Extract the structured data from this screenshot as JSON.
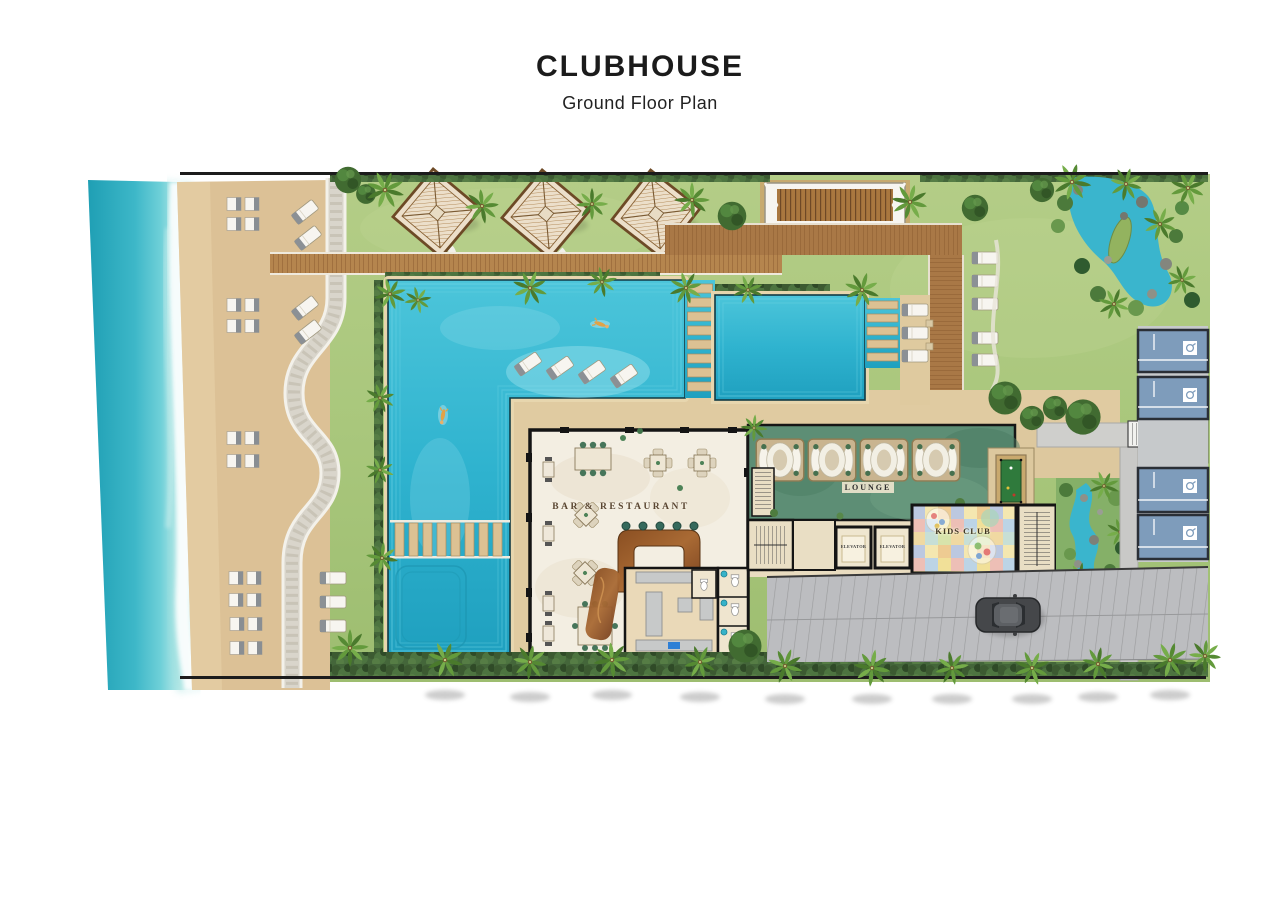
{
  "header": {
    "title": "CLUBHOUSE",
    "subtitle": "Ground Floor Plan"
  },
  "plan": {
    "labels": {
      "bar_restaurant": "BAR & RESTAURANT",
      "lounge": "LOUNGE",
      "kids_club": "KIDS CLUB",
      "elevator_left": "ELEVATOR",
      "elevator_right": "ELEVATOR"
    },
    "areas": [
      "ocean",
      "beach",
      "beach-loungers",
      "lawn",
      "cabana-pavilions",
      "pergola",
      "timber-deck",
      "swimming-pool",
      "in-pool-loungers",
      "kids-pool",
      "bar-restaurant",
      "kitchen",
      "restrooms",
      "lounge",
      "day-bed-pods",
      "billiards-table",
      "elevators",
      "staircases",
      "kids-club",
      "water-garden",
      "rock-pond",
      "residence-roofs",
      "driveway",
      "car",
      "palm-trees",
      "hedge"
    ],
    "colors": {
      "ocean": "#3fb6c6",
      "sand": "#dcc196",
      "grass": "#a9c77c",
      "pool": "#2fb3cf",
      "deck": "#a97a46",
      "marble": "#f3eee2",
      "lounge_carpet": "#5d8e75",
      "kids_club_floor": "#f1e098",
      "roof": "#7e9cbb",
      "road": "#bcbdc0",
      "wall": "#141414"
    }
  }
}
